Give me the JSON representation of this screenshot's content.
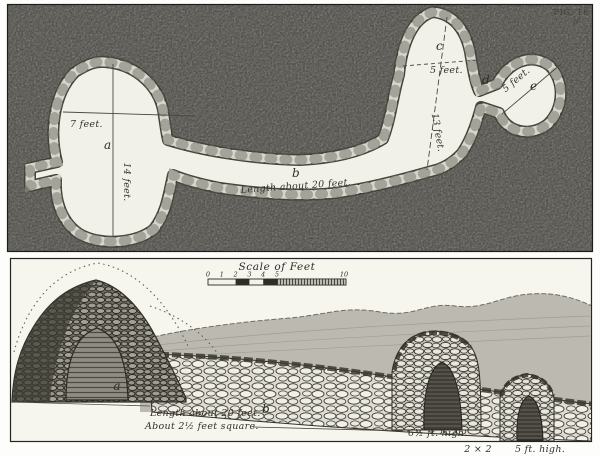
{
  "figure": {
    "label": "FIG. 18",
    "north_mark": "N"
  },
  "plan": {
    "chamber_a_letter": "a",
    "chamber_a_width_label": "7 feet.",
    "chamber_a_length_label": "14 feet.",
    "passage_b_letter": "b",
    "passage_b_length_label": "Length about 20 feet.",
    "chamber_c_letter": "c",
    "chamber_c_width_label": "5 feet.",
    "chamber_c_length_label": "13 feet.",
    "passage_d_letter": "d",
    "chamber_e_letter": "e",
    "chamber_e_width_label": "5 feet."
  },
  "section": {
    "scale_title": "Scale of Feet",
    "scale_ticks": [
      "0",
      "1",
      "2",
      "3",
      "4",
      "5",
      "10"
    ],
    "chamber_a_letter": "a",
    "passage_b_letter": "b",
    "passage_length_label": "Length about 20 feet.",
    "passage_size_label": "About 2½ feet square.",
    "middle_arch_height_label": "6½ ft. high.",
    "opening_size_label": "2 × 2",
    "right_arch_height_label": "5 ft. high."
  },
  "colors": {
    "plan_background": "#a8a69e",
    "chamber_fill": "#f2f1e9",
    "stone_ring_dark": "#45433a",
    "stone_ring_light": "#d8d6cc",
    "paper": "#f6f5ee",
    "ink": "#2e2c26"
  }
}
